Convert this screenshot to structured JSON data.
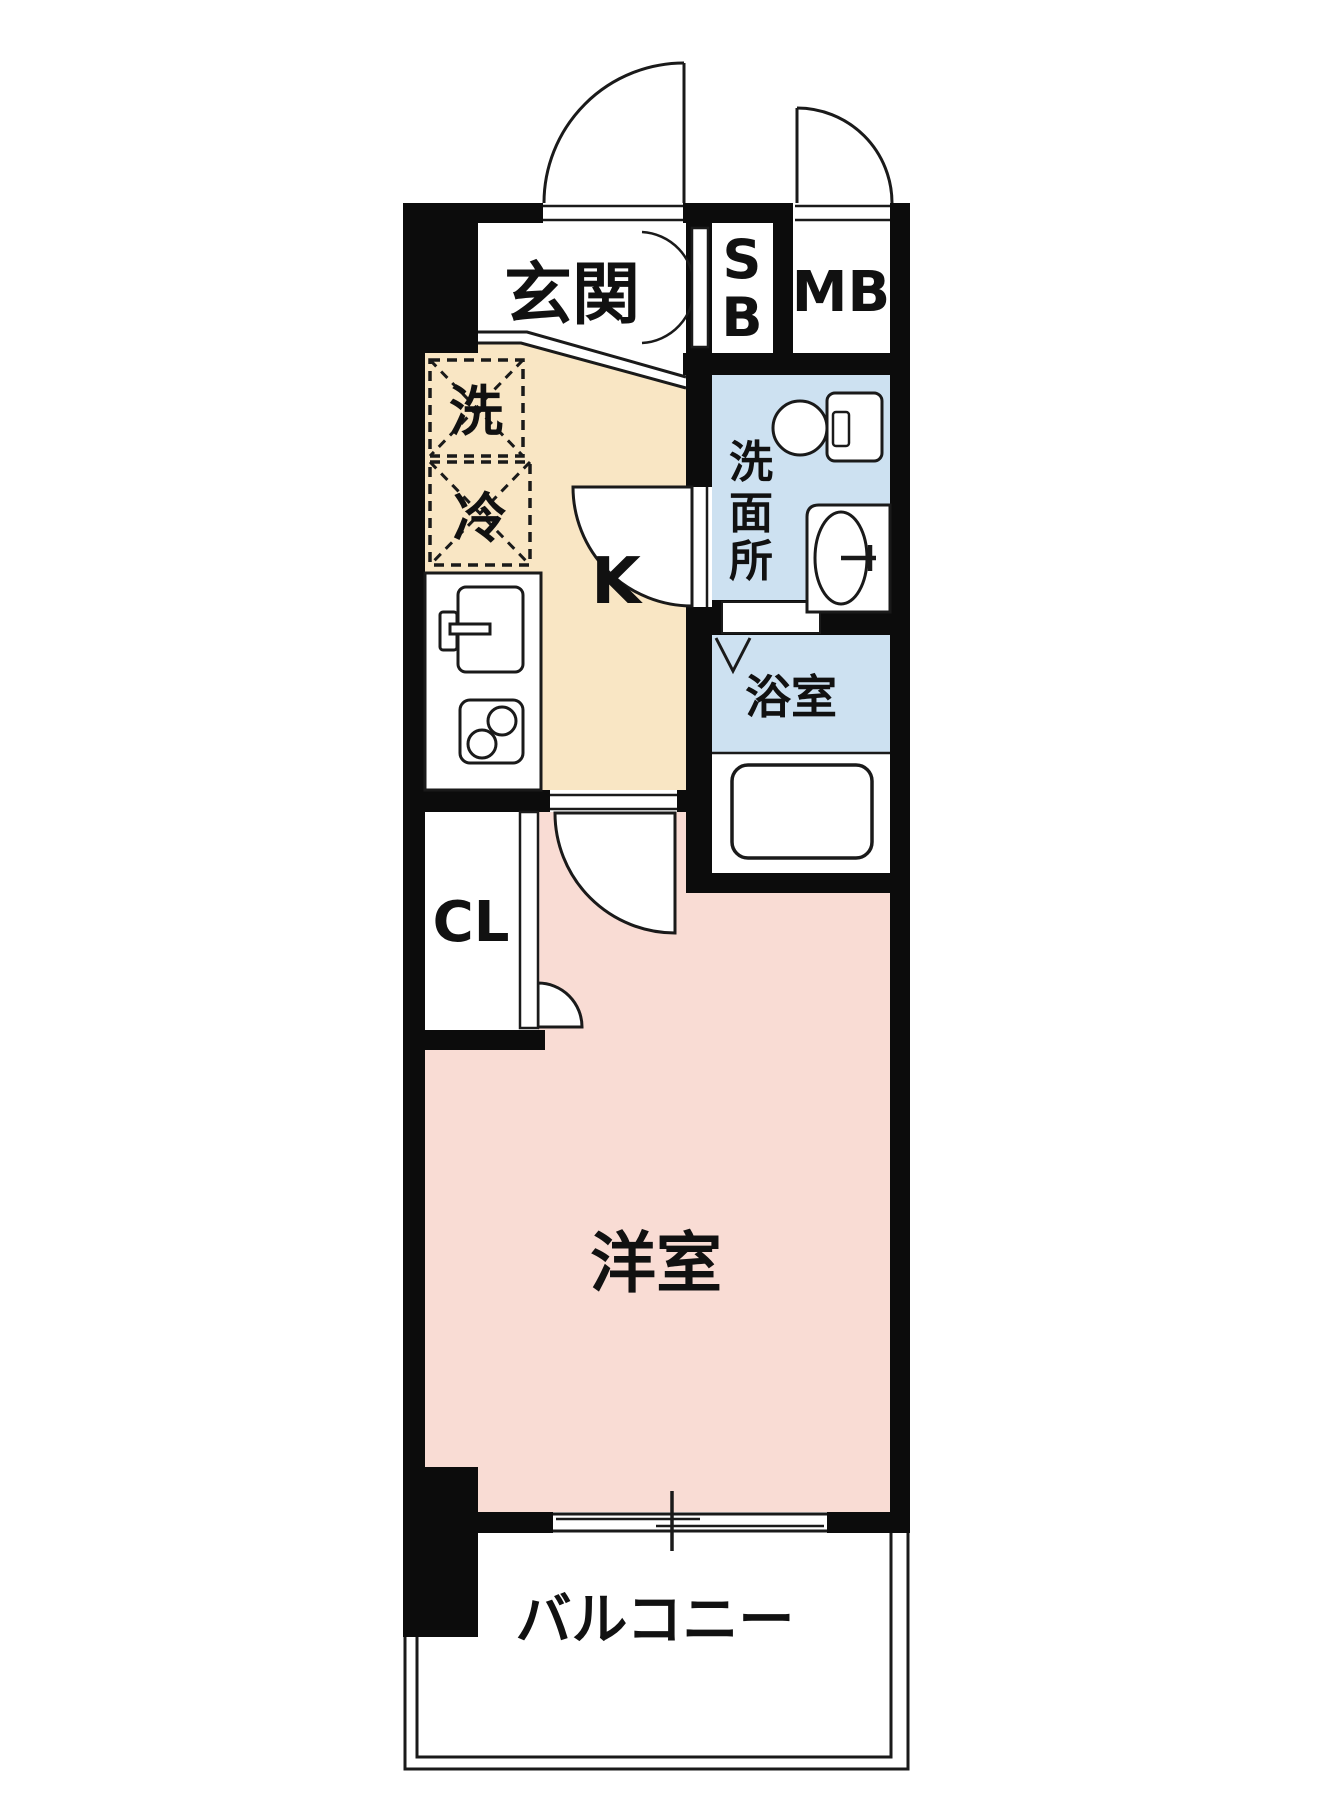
{
  "floorplan": {
    "labels": {
      "entrance": "玄関",
      "shoe_box_top": "S",
      "shoe_box_bottom": "B",
      "meter_box": "MB",
      "kitchen": "K",
      "washer_box": "洗",
      "fridge_box": "冷",
      "washroom_vertical": [
        "洗",
        "面",
        "所"
      ],
      "bathroom": "浴室",
      "closet": "CL",
      "western_room": "洋室",
      "balcony": "バルコニー"
    },
    "colors": {
      "kitchen_floor": "#f9e6c4",
      "wet_area_floor": "#cde1f1",
      "room_floor": "#f9dcd4",
      "wall": "#0c0c0c"
    }
  }
}
